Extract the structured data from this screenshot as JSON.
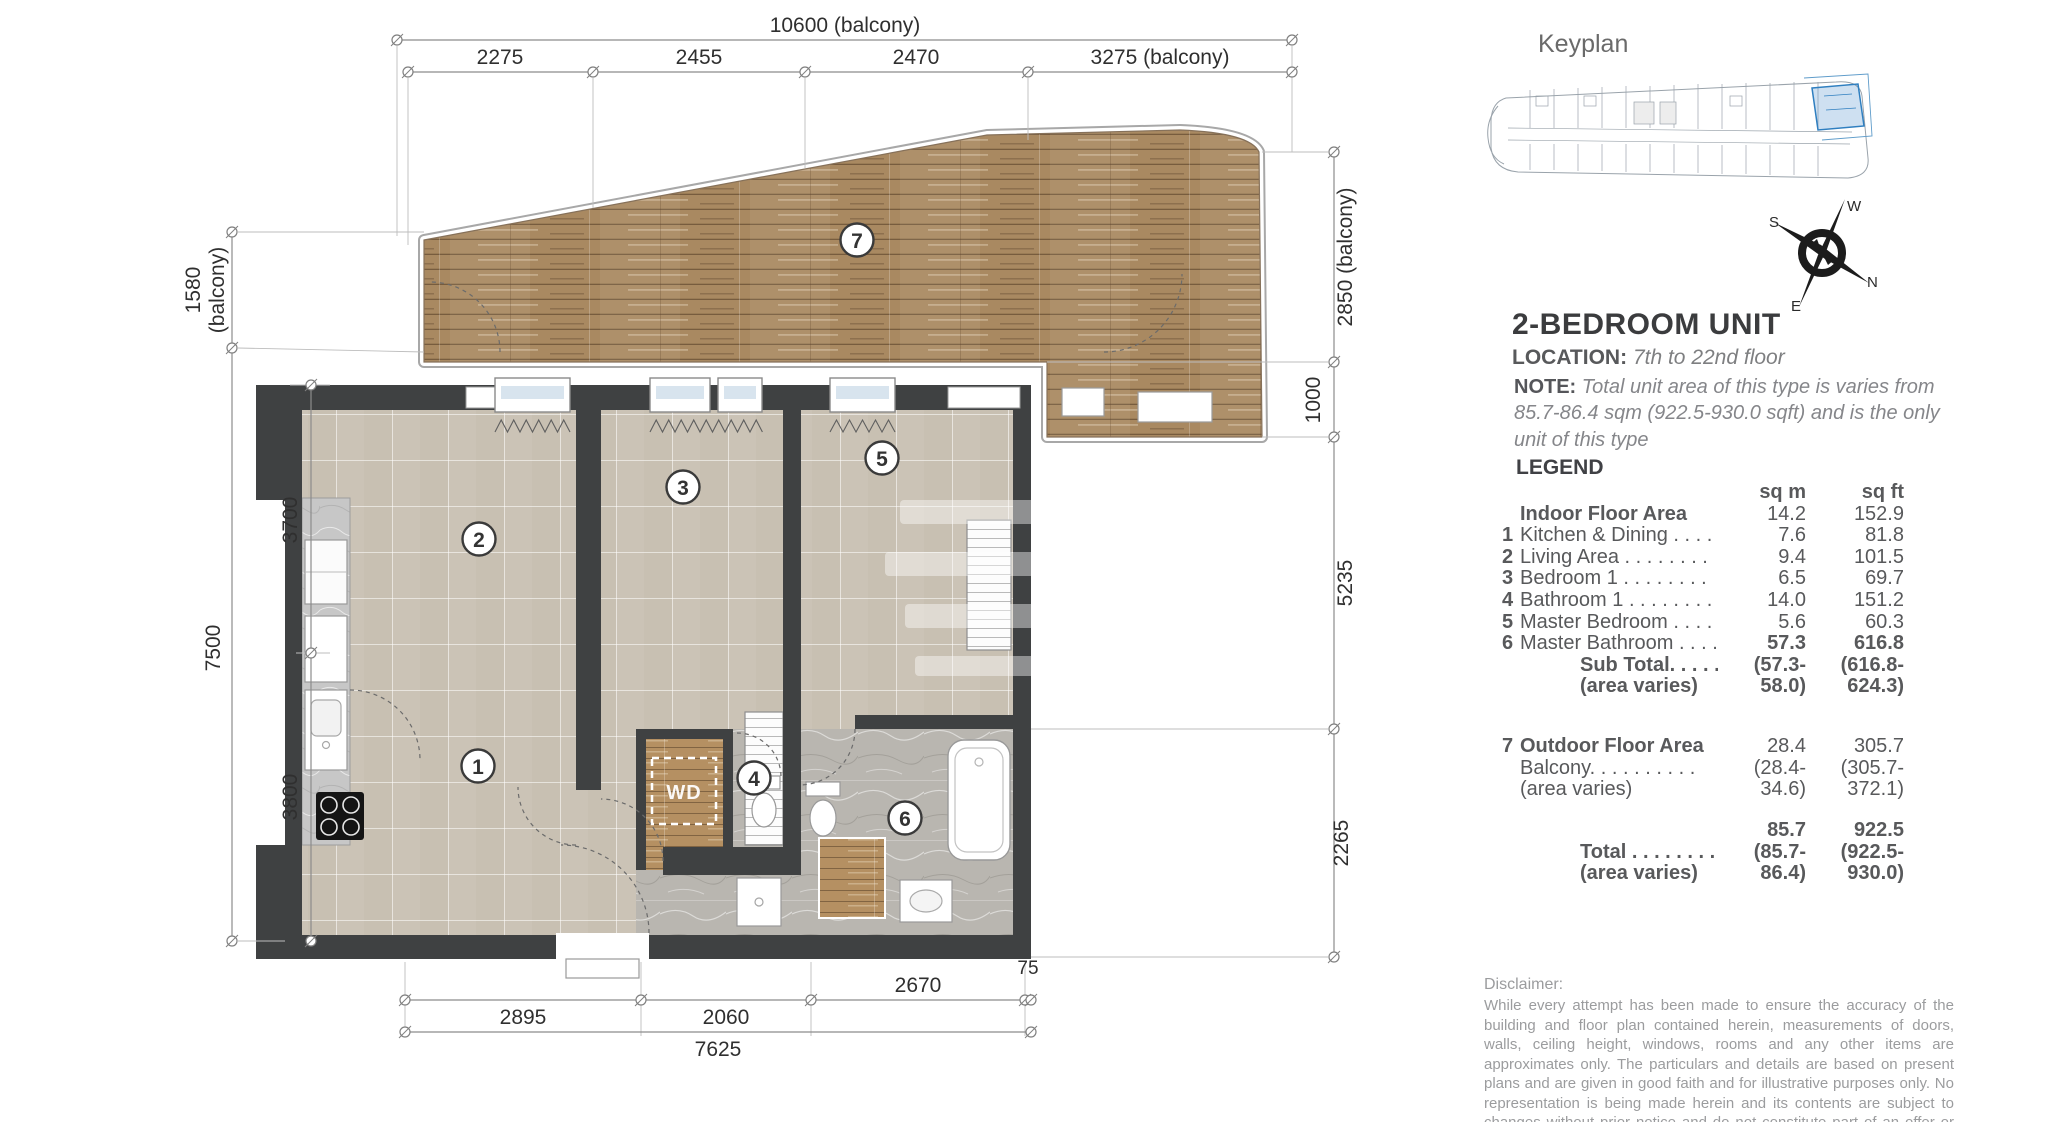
{
  "unit": {
    "keyplan_label": "Keyplan",
    "title": "2-BEDROOM UNIT",
    "location_label": "LOCATION:",
    "location": "7th to 22nd floor",
    "note_label": "NOTE:",
    "note": "Total unit area of this type is varies from 85.7-86.4 sqm (922.5-930.0 sqft) and is the only unit of this type"
  },
  "legend": {
    "heading": "LEGEND",
    "col_sqm": "sq m",
    "col_sqft": "sq ft",
    "indoor_rows": [
      {
        "num": "",
        "label": "Indoor Floor Area",
        "sqm": "14.2",
        "sqft": "152.9"
      },
      {
        "num": "1",
        "label": "Kitchen & Dining . . . . .",
        "sqm": "7.6",
        "sqft": "81.8"
      },
      {
        "num": "2",
        "label": "Living Area . . . . . . . .",
        "sqm": "9.4",
        "sqft": "101.5"
      },
      {
        "num": "3",
        "label": "Bedroom 1 . . . . . . . .",
        "sqm": "6.5",
        "sqft": "69.7"
      },
      {
        "num": "4",
        "label": "Bathroom 1 . . . . . . . .",
        "sqm": "14.0",
        "sqft": "151.2"
      },
      {
        "num": "5",
        "label": "Master Bedroom . . . . .",
        "sqm": "5.6",
        "sqft": "60.3"
      },
      {
        "num": "6",
        "label": "Master Bathroom . . . . .",
        "sqm": "57.3",
        "sqft": "616.8"
      },
      {
        "num": "",
        "label": "Sub Total. . . . . . .",
        "sqm": "(57.3-",
        "sqft": "(616.8-"
      },
      {
        "num": "",
        "label": "(area varies)",
        "sqm": "58.0)",
        "sqft": "624.3)"
      }
    ],
    "outdoor_rows": [
      {
        "num": "7",
        "label": "Outdoor Floor Area",
        "sqm": "28.4",
        "sqft": "305.7"
      },
      {
        "num": "",
        "label": "Balcony.  . . . . . . . . .",
        "sqm": "(28.4-",
        "sqft": "(305.7-"
      },
      {
        "num": "",
        "label": "(area varies)",
        "sqm": "34.6)",
        "sqft": "372.1)"
      }
    ],
    "total_rows": [
      {
        "label": "",
        "sqm": "85.7",
        "sqft": "922.5"
      },
      {
        "label": "Total . . . . . . . . .",
        "sqm": "(85.7-",
        "sqft": "(922.5-"
      },
      {
        "label": "(area varies)",
        "sqm": "86.4)",
        "sqft": "930.0)"
      }
    ]
  },
  "rooms": {
    "r1": "1",
    "r2": "2",
    "r3": "3",
    "r4": "4",
    "r5": "5",
    "r6": "6",
    "r7": "7"
  },
  "labels": {
    "wd": "WD"
  },
  "compass": {
    "n": "N",
    "s": "S",
    "e": "E",
    "w": "W"
  },
  "dims": {
    "d10600": "10600 (balcony)",
    "d2275": "2275",
    "d2455": "2455",
    "d2470": "2470",
    "d3275": "3275 (balcony)",
    "d1580a": "1580",
    "d1580b": "(balcony)",
    "d7500": "7500",
    "d3700": "3700",
    "d3800": "3800",
    "d2850": "2850 (balcony)",
    "d1000": "1000",
    "d5235": "5235",
    "d2265": "2265",
    "d2895": "2895",
    "d2060": "2060",
    "d2670": "2670",
    "d75": "75",
    "d7625": "7625"
  },
  "disclaimer": {
    "label": "Disclaimer:",
    "text": "While every attempt has been made to ensure the accuracy of the building and floor plan contained herein, measurements of doors, walls, ceiling height, windows, rooms and any other items are approximates only. The particulars and details are based on present plans and are given in good faith and for illustrative purposes only.  No representation is being made herein and its contents are subject to changes without prior notice and do not constitute part of an offer or contract. Plans are not to scale."
  },
  "colors": {
    "wall": "#3f4142",
    "wood": "#a98961",
    "tile": "#cbc3b6",
    "marble": "#b9b6b0",
    "keyplan_highlight": "#2f7fc0",
    "dim_line": "#8c8c8c"
  }
}
